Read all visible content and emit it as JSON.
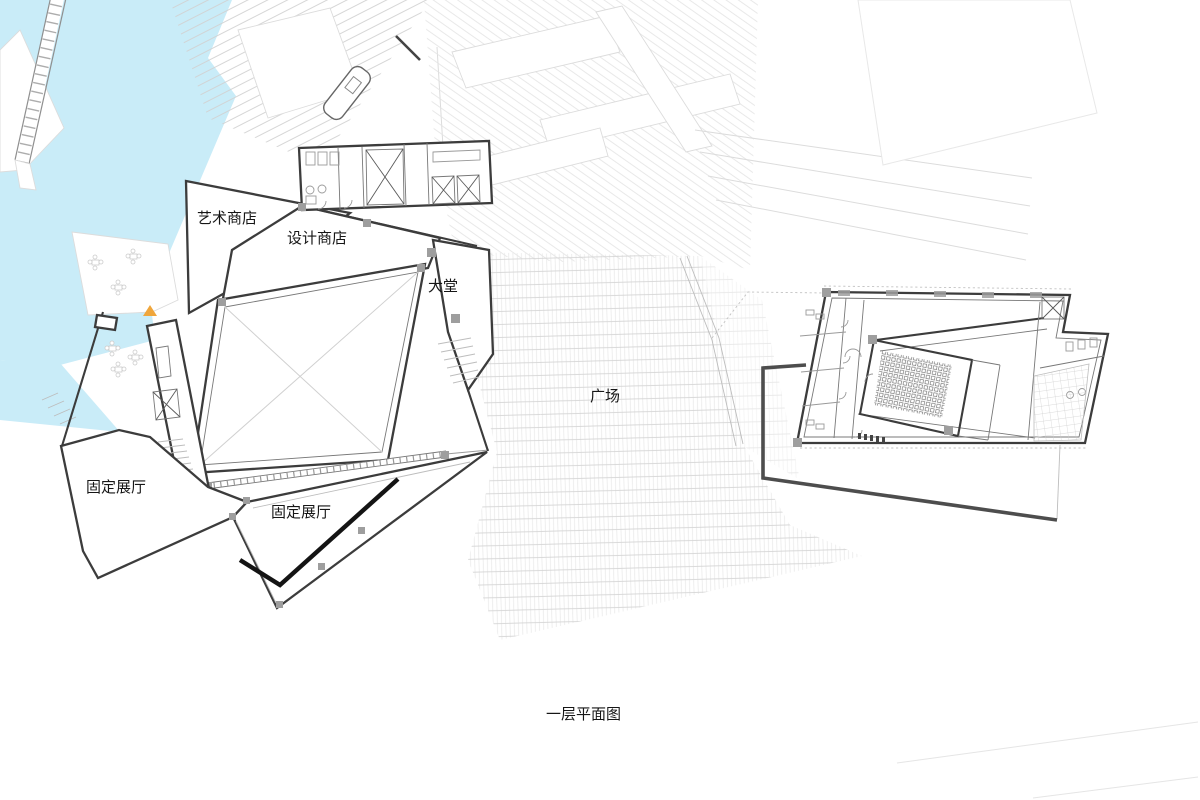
{
  "drawing": {
    "caption": "一层平面图",
    "rooms": {
      "art_shop": "艺术商店",
      "design_shop": "设计商店",
      "lobby": "大堂",
      "plaza": "广场",
      "exhibit_left": "固定展厅",
      "exhibit_bottom": "固定展厅"
    }
  },
  "colors": {
    "water": "#c9ecf8",
    "wall": "#3c3c3c",
    "context": "#dcdcdc",
    "accent": "#efa63c",
    "black_wall": "#141414",
    "site": "#4d4d4d",
    "ink": "#161616"
  }
}
